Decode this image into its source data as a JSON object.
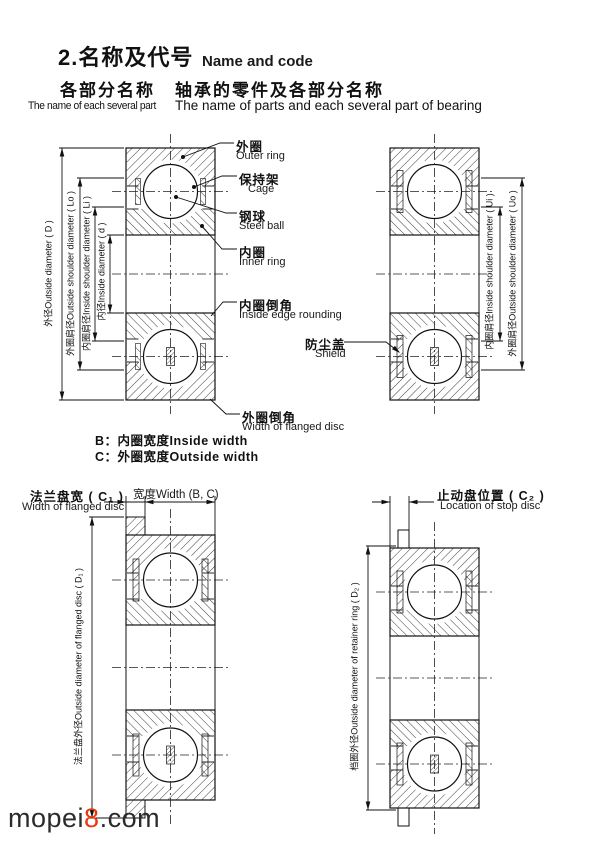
{
  "header": {
    "title_zh": "2.名称及代号",
    "title_en": "Name and code",
    "col_left_zh": "各部分名称",
    "col_left_en": "The name of each several part",
    "col_right_zh": "轴承的零件及各部分名称",
    "col_right_en": "The name of parts and each several part of bearing"
  },
  "parts": [
    {
      "zh": "外圈",
      "en": "Outer ring"
    },
    {
      "zh": "保持架",
      "en": "Cage"
    },
    {
      "zh": "钢球",
      "en": "Steel ball"
    },
    {
      "zh": "内圈",
      "en": "Inner ring"
    },
    {
      "zh": "内圈倒角",
      "en": "Inside edge rounding"
    },
    {
      "zh": "防尘盖",
      "en": "Shield"
    },
    {
      "zh": "外圈倒角",
      "en": "Width of flanged disc"
    }
  ],
  "dims": {
    "D": "外径Outside diameter ( D )",
    "Lo": "外圈肩径Outside shoulder diameter ( Lo )",
    "Li": "内圈肩径Inside shoulder diameter ( Li )",
    "d": "内径Inside diameter ( d )",
    "Ui": "内圈肩径Inside shoulder diameter ( Ui )",
    "Uo": "外圈肩径Outside shoulder diameter ( Uo )",
    "D1": "法兰盘外径Outside diameter of flanged disc ( D₁ )",
    "D2": "档圈外径Outside diameter of retainer ring ( D₂ )"
  },
  "width_notes": {
    "b": "B：内圈宽度Inside width",
    "c": "C：外圈宽度Outside width"
  },
  "bottom_left": {
    "flange_width_zh": "法兰盘宽 ( C₁ )",
    "flange_width_en": "Width of flanged disc",
    "width_label": "宽度Width (B, C)"
  },
  "bottom_right": {
    "stop_disc_zh": "止动盘位置 ( C₂ )",
    "stop_disc_en": "Location of stop disc"
  },
  "watermark": {
    "pre": "mopei",
    "accent": "8",
    "post": ".com",
    "accent_color": "#e8380d"
  }
}
